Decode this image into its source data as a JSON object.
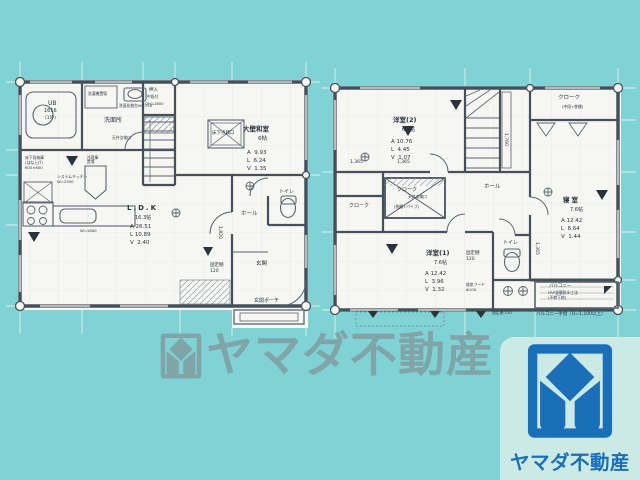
{
  "colors": {
    "background": "#80d2d4",
    "paper": "#f6f6f2",
    "wall": "#46505c",
    "brand_blue": "#1a6fb8",
    "brand_card": "#cbeae5",
    "watermark_gray": "#7f9ea2"
  },
  "watermark": {
    "text": "ヤマダ不動産"
  },
  "brand": {
    "name": "ヤマダ不動産"
  },
  "floor1": {
    "ub": {
      "line1": "UB",
      "line2": "1616",
      "line3": "(1坪)"
    },
    "washroom": "洗面所",
    "laundry": "洗濯機置場",
    "vanity_note": "洗面化粧台W=750",
    "ceiling_hatch": "天井点検口",
    "oshiire": {
      "line1": "押入",
      "line2": "中段付",
      "line3": "DH≒1800"
    },
    "washitsu": {
      "name": "大壁和室",
      "size": "6帖",
      "stats": [
        "A  9.93",
        "L  6.24",
        "V  1.35"
      ]
    },
    "floor_hatch": "床下点検口",
    "ldk": {
      "name": "L.D.K",
      "size": "16.3帖",
      "stats": [
        "A 26.51",
        "L 10.89",
        "V  2.40"
      ]
    },
    "fridge": "冷蔵庫置場",
    "floor_storage": "床下収納庫\n(はね上げ)\n600×600",
    "kitchen_note": "システムキッチン\nW=2550",
    "counter_note": "W=1800",
    "hall": "ホール",
    "toilet": "トイレ",
    "entrance": "玄関",
    "porch": "玄関ポーチ",
    "shelf_note": "固定棚\n120",
    "dim_vertical": "1,820"
  },
  "floor2": {
    "yoshitsu2": {
      "name": "洋室(2)",
      "size": "6.6帖",
      "stats": [
        "A 10.76",
        "L  4.45",
        "V  1.07"
      ]
    },
    "yoshitsu1": {
      "name": "洋室(1)",
      "size": "7.6帖",
      "stats": [
        "A 12.42",
        "L  3.96",
        "V  1.32"
      ]
    },
    "shinshitsu": {
      "name": "寝室",
      "size": "7.6帖",
      "stats": [
        "A 12.42",
        "L  8.64",
        "V  1.44"
      ]
    },
    "cloak_top": "クローク",
    "cloak_top_note": "(中段+枕棚)",
    "cloak_mid": "クローク",
    "cloak_mid_note1": "天井点検口",
    "cloak_mid_note2": "(枕棚+パイプ)",
    "cloak_left": "クローク",
    "hall": "ホール",
    "toilet": "トイレ",
    "balcony": "バルコニー",
    "balcony_note": "FRP塗膜防水工法\n(不燃下地)",
    "balcony_rail": "バルコニー手摺（H=1,100以上）",
    "shelf_note": "固定棚\n120",
    "shelf_note2": "固定棚 120",
    "fan_note": "換気フード\nΦ100",
    "dim_h1": "1,365",
    "dim_h2": "1,365",
    "dim_v1": "1,760",
    "dim_v2": "1,365"
  }
}
